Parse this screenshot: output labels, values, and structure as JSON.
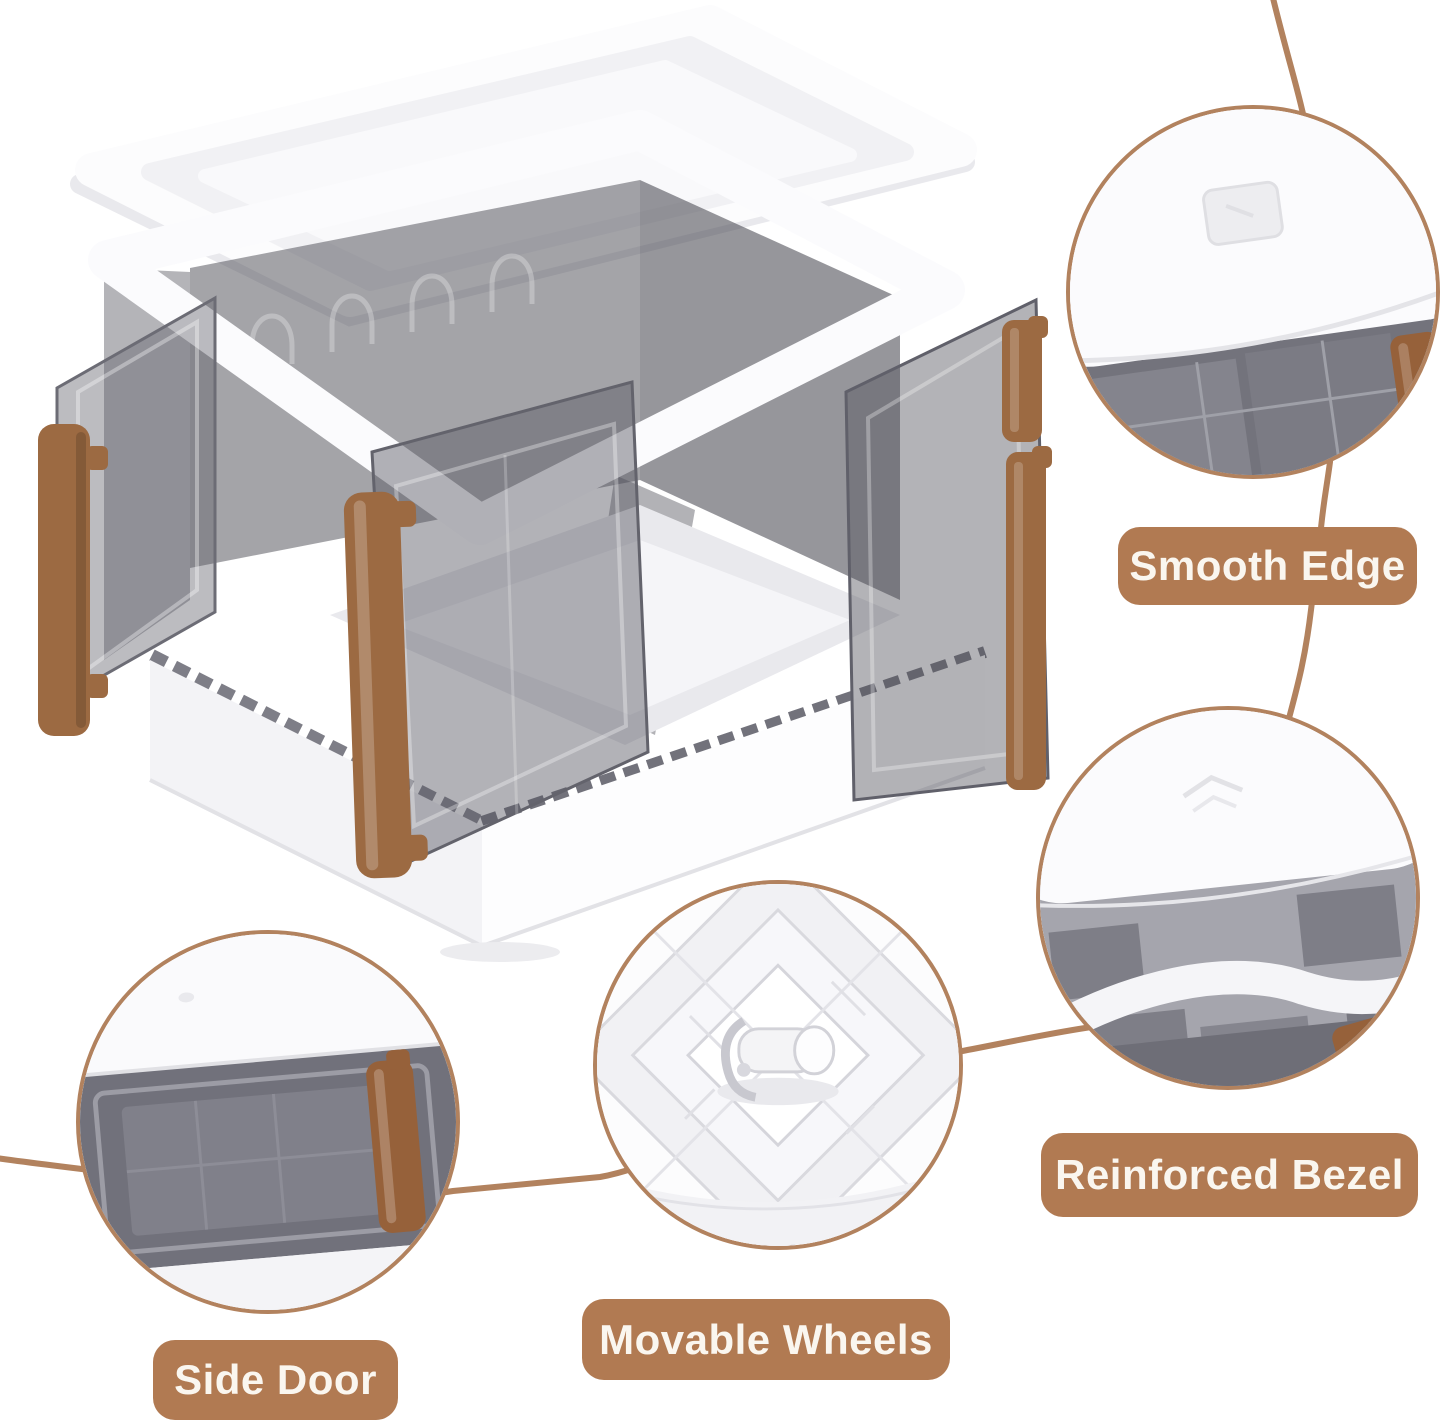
{
  "colors": {
    "label_bg": "#b17a52",
    "label_text": "#faf6ef",
    "connector": "#b2825e",
    "handle_brown": "#9c6a42",
    "clip_brown": "#96613a",
    "panel_smoke": "#6f6f78",
    "plastic_white": "#fbfbfd"
  },
  "callouts": [
    {
      "id": "smooth-edge",
      "label": "Smooth Edge"
    },
    {
      "id": "reinforced-bezel",
      "label": "Reinforced Bezel"
    },
    {
      "id": "movable-wheels",
      "label": "Movable Wheels"
    },
    {
      "id": "side-door",
      "label": "Side Door"
    }
  ]
}
